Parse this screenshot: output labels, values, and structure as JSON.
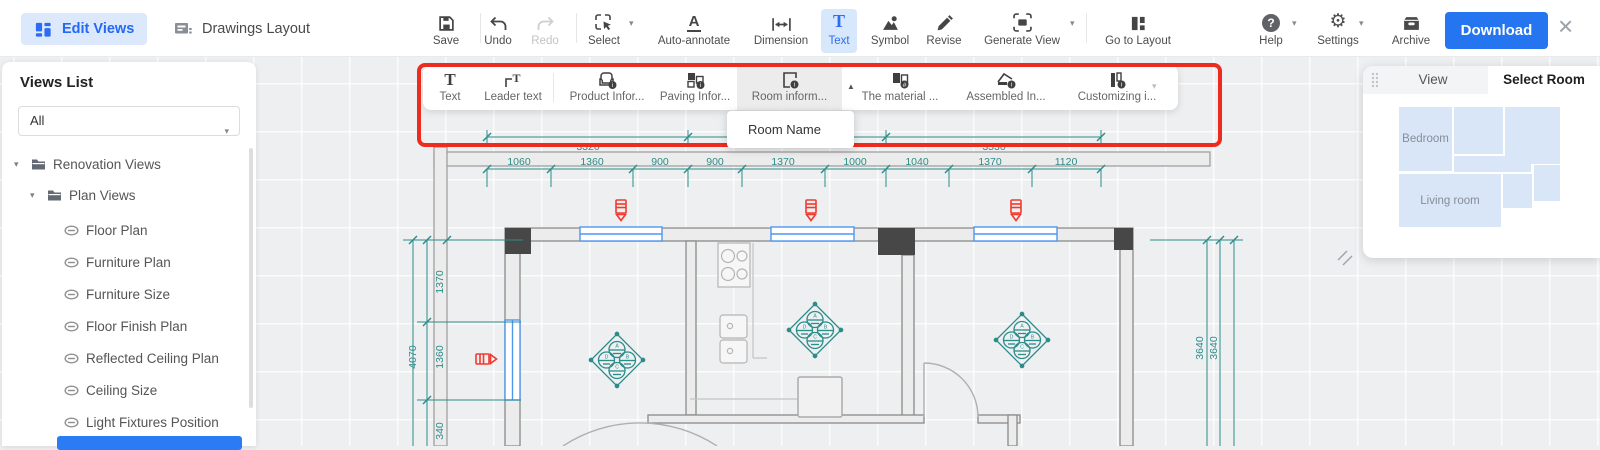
{
  "topbar": {
    "mode_edit_views": "Edit Views",
    "mode_drawings_layout": "Drawings Layout",
    "tools": {
      "save": "Save",
      "undo": "Undo",
      "redo": "Redo",
      "select": "Select",
      "auto_annotate": "Auto-annotate",
      "dimension": "Dimension",
      "text": "Text",
      "symbol": "Symbol",
      "revise": "Revise",
      "generate_view": "Generate View",
      "go_to_layout": "Go to Layout",
      "help": "Help",
      "settings": "Settings",
      "archive": "Archive"
    },
    "download_label": "Download"
  },
  "ribbon": {
    "text": "Text",
    "leader_text": "Leader text",
    "product_info": "Product Infor...",
    "paving_info": "Paving Infor...",
    "room_info": "Room inform...",
    "material_info": "The material ...",
    "assembled_info": "Assembled In...",
    "customizing_info": "Customizing i...",
    "dropdown_item": "Room Name"
  },
  "sidebar": {
    "title": "Views List",
    "filter_value": "All",
    "root": "Renovation Views",
    "group": "Plan Views",
    "leaves": [
      "Floor Plan",
      "Furniture Plan",
      "Furniture Size",
      "Floor Finish Plan",
      "Reflected Ceiling Plan",
      "Ceiling Size",
      "Light Fixtures Position"
    ]
  },
  "panel": {
    "tab_view": "View",
    "tab_select_room": "Select Room",
    "room_bedroom": "Bedroom",
    "room_living": "Living room"
  },
  "plan": {
    "dims_top": [
      "3320",
      "3530"
    ],
    "dims_row2": [
      "1060",
      "1360",
      "900",
      "900",
      "1370",
      "1000",
      "1040",
      "1370",
      "1120"
    ],
    "dims_left": {
      "seg1": "1370",
      "seg2": "1360",
      "seg3": "340",
      "total": "4070"
    },
    "dims_right": [
      "3640",
      "3640"
    ],
    "lamp_letters": [
      "A",
      "B",
      "C",
      "D"
    ]
  },
  "colors": {
    "accent_blue": "#2a6df4",
    "dimension_teal": "#2b8c89",
    "highlight_red": "#ed2b1e",
    "window_blue": "#4f97ef",
    "symbol_red": "#f23a30"
  }
}
